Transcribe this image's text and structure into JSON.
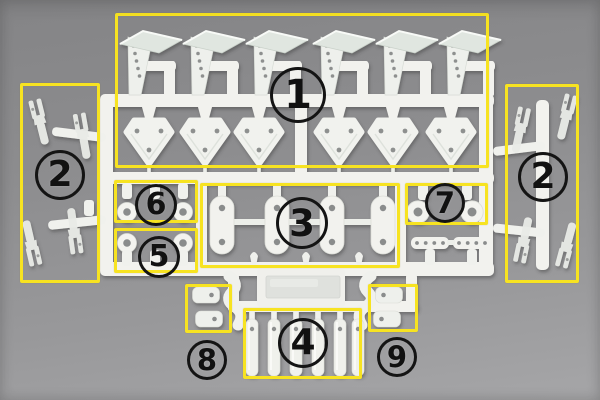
{
  "colors": {
    "background_gray": "#8f8f91",
    "sprue_plastic_white": "#f2f2ee",
    "highlight_yellow": "#f7e321",
    "annotation_black": "#141414"
  },
  "annotations": {
    "circles": [
      {
        "number": "1"
      },
      {
        "number": "2"
      },
      {
        "number": "2"
      },
      {
        "number": "3"
      },
      {
        "number": "4"
      },
      {
        "number": "5"
      },
      {
        "number": "6"
      },
      {
        "number": "7"
      },
      {
        "number": "8"
      },
      {
        "number": "9"
      }
    ]
  }
}
